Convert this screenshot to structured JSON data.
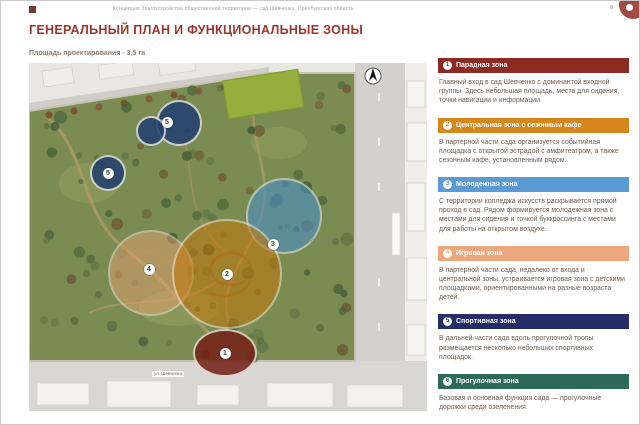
{
  "page": {
    "doc_header": "Концепция благоустройства общественной территории — сад Шевченко, Оренбургская область",
    "page_number": "8",
    "title": "ГЕНЕРАЛЬНЫЙ ПЛАН И ФУНКЦИОНАЛЬНЫЕ ЗОНЫ",
    "subtitle": "Площадь проектирования - 3,5 га"
  },
  "map": {
    "labels": {
      "college": "колледж искусств",
      "street_bottom": "ул. Шевченко"
    },
    "zones": [
      {
        "zone": "Спортивная зона",
        "num": "5",
        "color": "#24406f",
        "cx": 150,
        "cy": 60,
        "rx": 23,
        "ry": 23,
        "opacity": 0.88
      },
      {
        "zone": "Спортивная зона",
        "num": "5",
        "color": "#24406f",
        "cx": 122,
        "cy": 68,
        "rx": 15,
        "ry": 15,
        "opacity": 0.88
      },
      {
        "zone": "Спортивная зона",
        "num": "5",
        "color": "#24406f",
        "cx": 79,
        "cy": 110,
        "rx": 18,
        "ry": 18,
        "opacity": 0.88
      },
      {
        "zone": "Молодежная зона",
        "num": "3",
        "color": "#4b8fc6",
        "cx": 255,
        "cy": 153,
        "rx": 38,
        "ry": 38,
        "opacity": 0.6
      },
      {
        "zone": "Игровая зона",
        "num": "4",
        "color": "#e5a071",
        "cx": 122,
        "cy": 210,
        "rx": 43,
        "ry": 43,
        "opacity": 0.5
      },
      {
        "zone": "Центральная зона",
        "num": "2",
        "color": "#c2790f",
        "cx": 198,
        "cy": 211,
        "rx": 55,
        "ry": 55,
        "opacity": 0.58
      },
      {
        "zone": "Парадная зона",
        "num": "1",
        "color": "#731f16",
        "cx": 196,
        "cy": 290,
        "rx": 32,
        "ry": 24,
        "opacity": 0.85
      }
    ],
    "markers": [
      {
        "num": "5",
        "x": 138,
        "y": 59
      },
      {
        "num": "5",
        "x": 79,
        "y": 110
      },
      {
        "num": "3",
        "x": 244,
        "y": 181
      },
      {
        "num": "2",
        "x": 198,
        "y": 211
      },
      {
        "num": "4",
        "x": 120,
        "y": 206
      },
      {
        "num": "1",
        "x": 196,
        "y": 290
      }
    ]
  },
  "legend": {
    "sections": [
      {
        "num": "1",
        "title": "Парадная зона",
        "color": "#8e2a21",
        "text": "Главный вход в сад Шевченко с доминантой входной группы. Здесь небольшая площадь, места для сидения, точки навигации и информации."
      },
      {
        "num": "2",
        "title": "Центральная зона с сезонным кафе",
        "color": "#d6871c",
        "text": "В партерной части сада организуется событийная площадка с открытой эстрадой с амфитеатром, а также сезонным кафе, установленным рядом."
      },
      {
        "num": "3",
        "title": "Молодежная зона",
        "color": "#5b9bd5",
        "text": "С территории колледжа искусств раскрывается прямой проход в сад. Рядом формируется молодежная зона с местами для сидения и точкой буккроссинга с местами для работы на открытом воздухе."
      },
      {
        "num": "4",
        "title": "Игровая зона",
        "color": "#eca77d",
        "text": "В партерной части сада, недалеко от входа и центральной зоны, устраивается игровая зона с детскими площадками, ориентированными на разные возраста детей."
      },
      {
        "num": "5",
        "title": "Спортивная зона",
        "color": "#252e68",
        "text": "В дальней части сада вдоль прогулочной тропы размещается несколько небольших спортивных площадок."
      },
      {
        "num": "6",
        "title": "Прогулочная зона",
        "color": "#2e6a59",
        "text": "Базовая и основная функция сада — прогулочные дорожки среди озеленения."
      }
    ]
  }
}
